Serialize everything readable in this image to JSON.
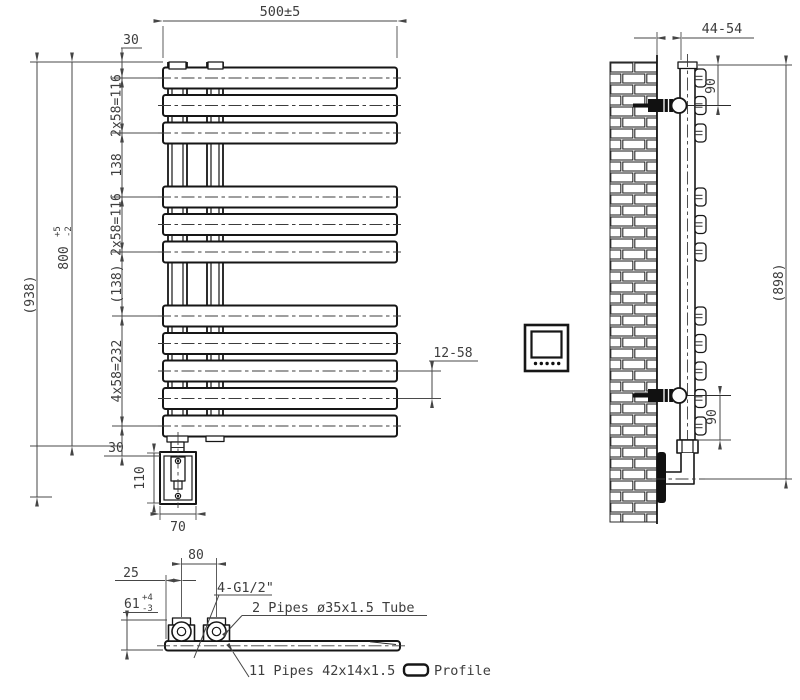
{
  "drawing": {
    "front": {
      "width_top": "500±5",
      "offset_top": "30",
      "pitch_group_top": "2x58=116",
      "gap_top": "138",
      "pitch_group_mid": "2x58=116",
      "gap_mid": "(138)",
      "pitch_group_bottom": "4x58=232",
      "offset_bottom": "30",
      "height": "800",
      "height_tol_plus": "+5",
      "height_tol_minus": "-2",
      "overall_height": "(938)",
      "bar_pitch_range": "12-58",
      "element_box_height": "110",
      "element_box_width": "70"
    },
    "side": {
      "wall_distance": "44-54",
      "bracket_offset_top": "90",
      "bracket_offset_bottom": "90",
      "overall_height": "(898)"
    },
    "bottom": {
      "pipe_spacing": "80",
      "end_offset": "25",
      "depth": "61",
      "depth_tol_plus": "+4",
      "depth_tol_minus": "-3",
      "connections_label": "4-G1/2\"",
      "tube_label": "2 Pipes ø35x1.5 Tube",
      "profile_label": "11 Pipes 42x14x1.5",
      "profile_word": "Profile"
    }
  }
}
